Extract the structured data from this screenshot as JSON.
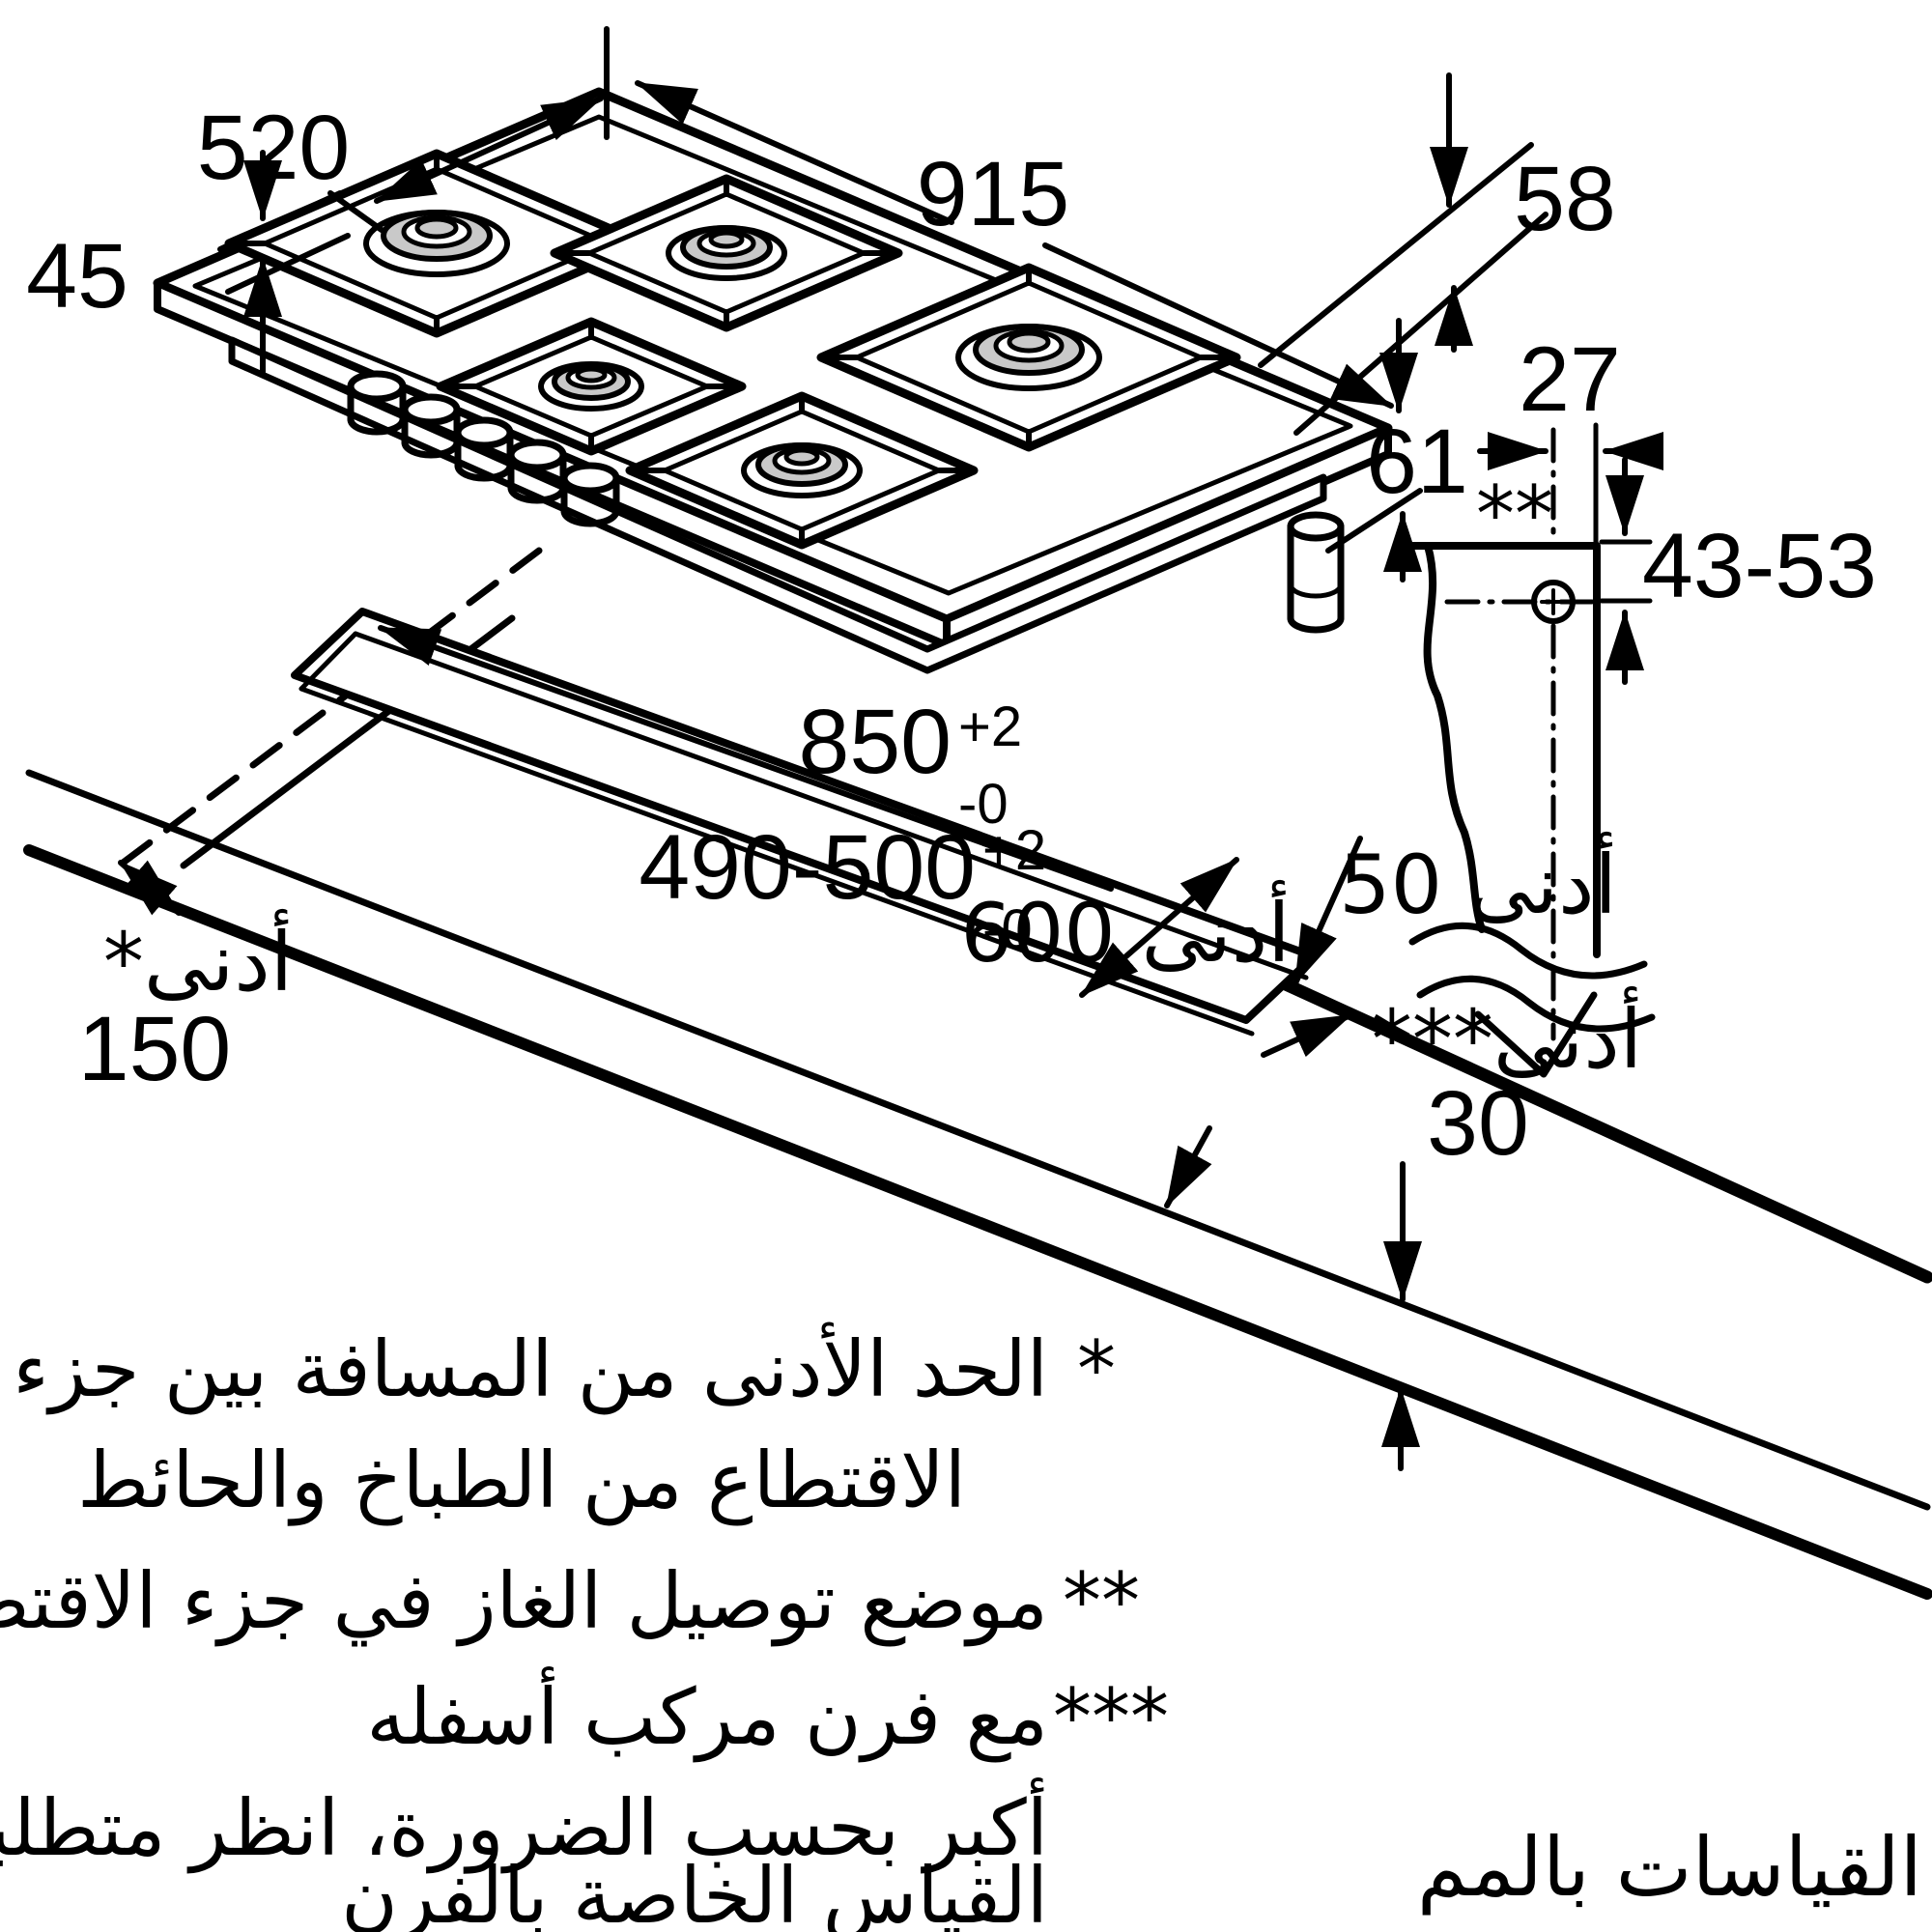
{
  "units_note": "القياسات بالمم",
  "colors": {
    "line": "#000000",
    "burner_cap": "#c9c9c9",
    "background": "#ffffff"
  },
  "labels": {
    "width": "915",
    "depth": "520",
    "glass_height": "45",
    "body_height": "58",
    "total_height": "61",
    "gas_offset": "27",
    "gas_marker": "**",
    "gas_height_range": "43-53",
    "cutout_width": "850",
    "cutout_depth": "490-500",
    "tol_plus": "+2",
    "tol_minus": "-0",
    "min_right": "أدنى 50",
    "min_front": "أدنى 600",
    "min_wall_label": "*أدنى",
    "min_wall_value": "150",
    "min_oven_label": "***أدنى",
    "min_oven_value": "30"
  },
  "footnotes": {
    "m1": "*",
    "t1": "الحد الأدنى من المسافة بين جزء",
    "t2": "الاقتطاع من الطباخ والحائط",
    "m2": "**",
    "t3": "موضع توصيل الغاز في جزء الاقتطاع",
    "m3": "***",
    "t4": "مع فرن مركب أسفله",
    "t5": "أكبر بحسب الضرورة، انظر متطلبات",
    "t6": "القياس الخاصة بالفرن"
  }
}
